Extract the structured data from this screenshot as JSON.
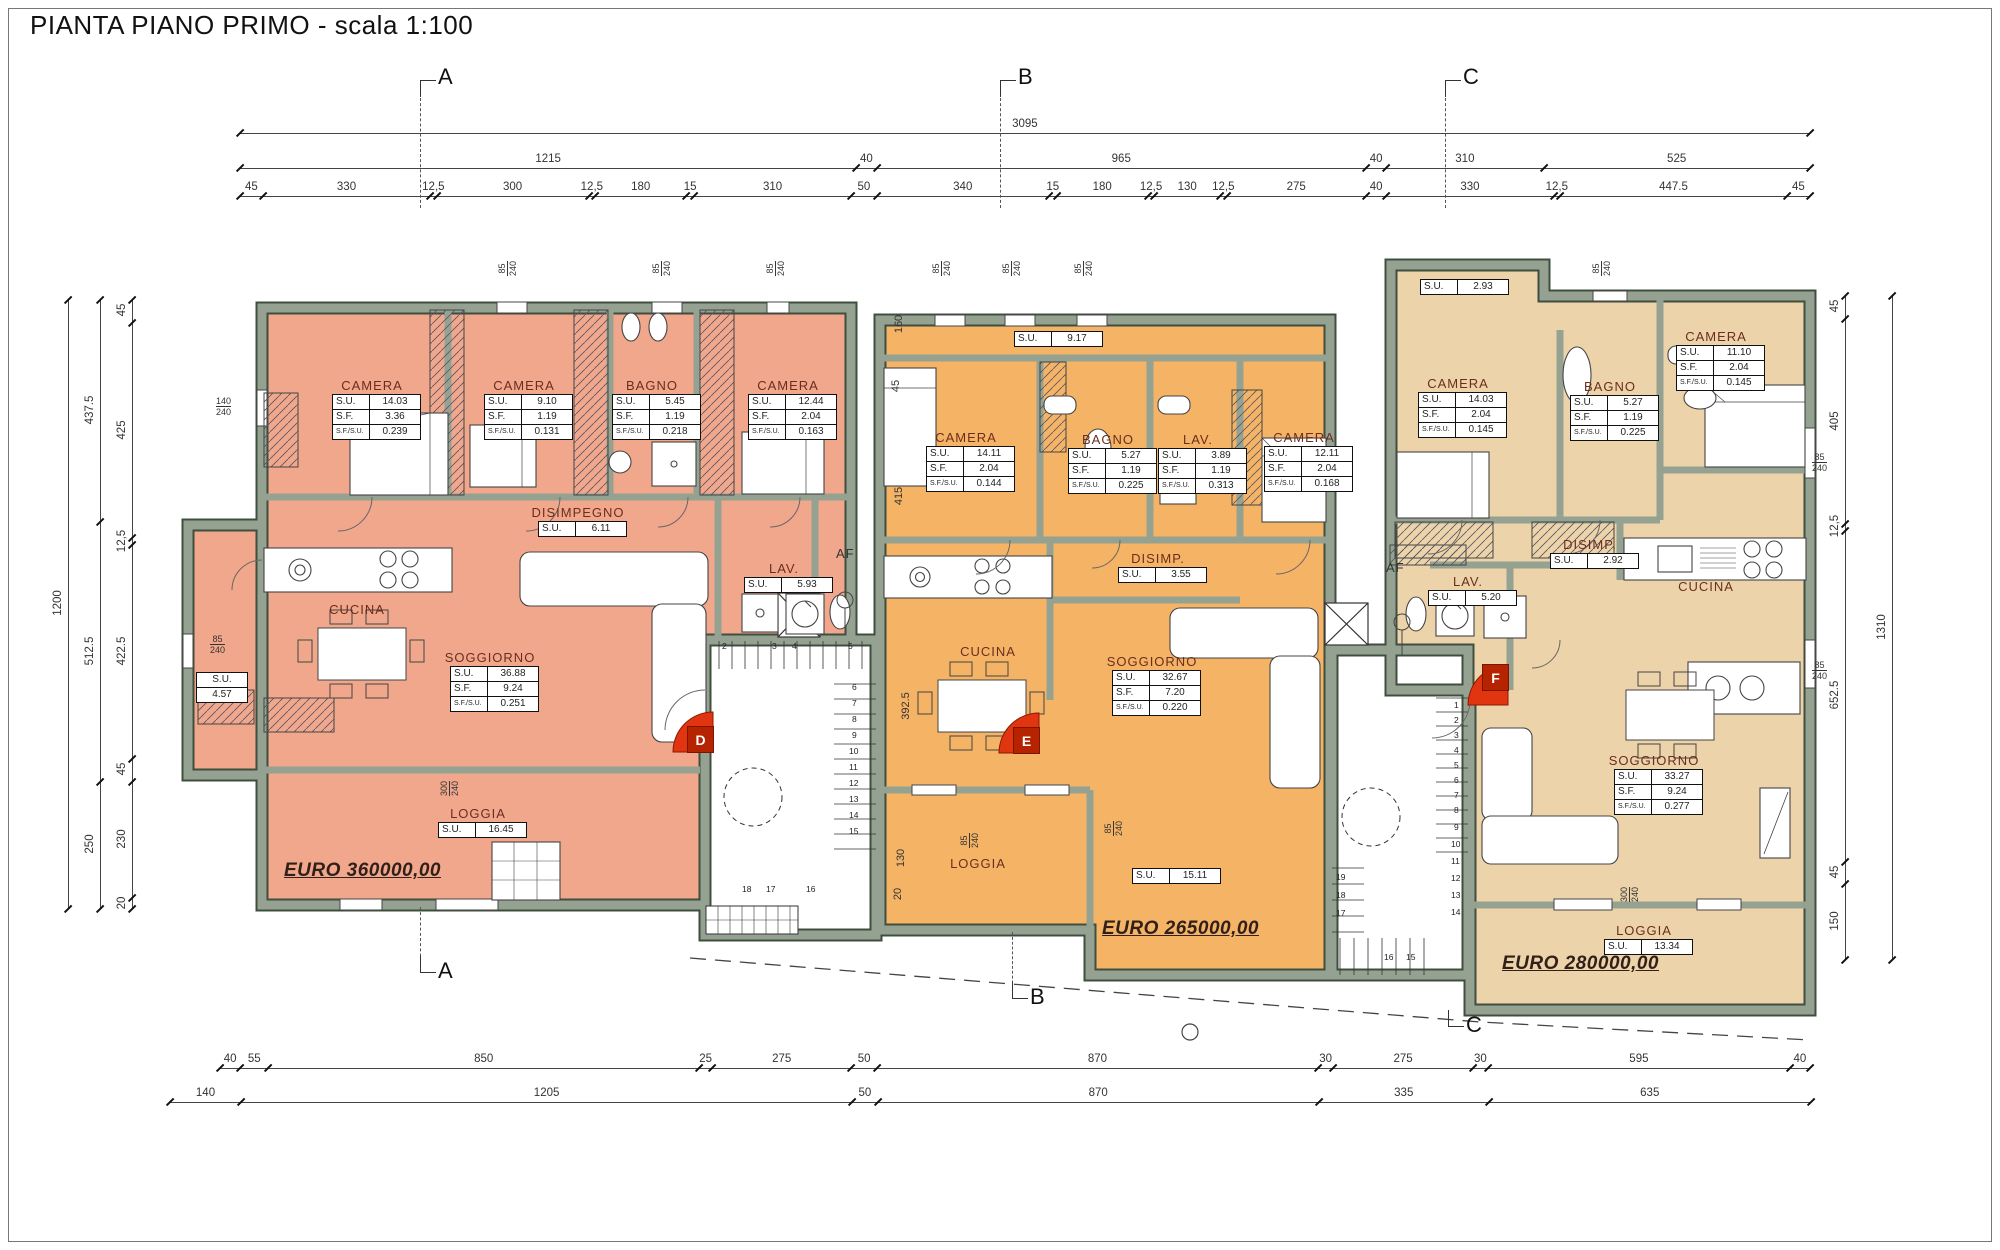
{
  "title": "PIANTA PIANO PRIMO - scala 1:100",
  "colors": {
    "apartment_d_fill": "#f1a78c",
    "apartment_e_fill": "#f5b366",
    "apartment_f_fill": "#ecd3a9",
    "wall_fill": "#95a292",
    "wall_edge": "#3f4f3f",
    "marker_red": "#e03510",
    "room_title_color": "#6b2e1e",
    "price_color": "#31201a"
  },
  "section_markers": {
    "top": [
      {
        "label": "A",
        "x": 420
      },
      {
        "label": "B",
        "x": 1000
      },
      {
        "label": "C",
        "x": 1445
      }
    ],
    "bottom": [
      {
        "label": "A",
        "x": 420,
        "y0": 907,
        "y1": 972
      },
      {
        "label": "B",
        "x": 1012,
        "y0": 932,
        "y1": 998
      },
      {
        "label": "C",
        "x": 1448,
        "y0": 1010,
        "y1": 1026
      }
    ]
  },
  "door_markers": [
    {
      "label": "D",
      "x": 687,
      "y": 726
    },
    {
      "label": "E",
      "x": 1013,
      "y": 727
    },
    {
      "label": "F",
      "x": 1482,
      "y": 664
    }
  ],
  "dimensions": {
    "scale": 0.5072,
    "top_rows": [
      {
        "y": 133,
        "x0": 240,
        "values": [
          "3095"
        ]
      },
      {
        "y": 168,
        "x0": 240,
        "values": [
          "1215",
          "40",
          "965",
          "40",
          "310",
          "525"
        ]
      },
      {
        "y": 196,
        "x0": 240,
        "values": [
          "45",
          "330",
          "12,5",
          "300",
          "12,5",
          "180",
          "15",
          "310",
          "50",
          "340",
          "15",
          "180",
          "12,5",
          "130",
          "12,5",
          "275",
          "40",
          "330",
          "12,5",
          "447.5",
          "45"
        ]
      }
    ],
    "bottom_rows": [
      {
        "y": 1068,
        "x0": 220,
        "values": [
          "40",
          "55",
          "850",
          "25",
          "275",
          "50",
          "870",
          "30",
          "275",
          "30",
          "595",
          "40"
        ]
      },
      {
        "y": 1102,
        "x0": 170,
        "values": [
          "140",
          "1205",
          "50",
          "870",
          "335",
          "635"
        ]
      }
    ],
    "left_cols": [
      {
        "x": 68,
        "y0": 300,
        "values": [
          "1200"
        ]
      },
      {
        "x": 100,
        "y0": 300,
        "values": [
          "437.5",
          "512.5",
          "250"
        ]
      },
      {
        "x": 132,
        "y0": 300,
        "values": [
          "45",
          "425",
          "12,5",
          "422.5",
          "45",
          "230",
          "20"
        ]
      }
    ],
    "right_cols": [
      {
        "x": 1845,
        "y0": 296,
        "values": [
          "45",
          "405",
          "12,5",
          "652.5",
          "45",
          "150"
        ]
      },
      {
        "x": 1892,
        "y0": 296,
        "values": [
          "1310"
        ]
      }
    ],
    "interior_rotated": [
      {
        "text": "160",
        "x": 910,
        "y": 318
      },
      {
        "text": "45",
        "x": 910,
        "y": 380
      },
      {
        "text": "415",
        "x": 910,
        "y": 490
      },
      {
        "text": "392.5",
        "x": 912,
        "y": 700
      },
      {
        "text": "130",
        "x": 912,
        "y": 852
      },
      {
        "text": "20",
        "x": 912,
        "y": 888
      }
    ]
  },
  "apartments": [
    {
      "id": "D",
      "price": "EURO 360000,00",
      "price_pos": [
        284,
        860
      ],
      "rooms": [
        {
          "name": "CAMERA",
          "su": "14.03",
          "sf": "3.36",
          "sfsu": "0.239",
          "x": 332,
          "y": 378
        },
        {
          "name": "CAMERA",
          "su": "9.10",
          "sf": "1.19",
          "sfsu": "0.131",
          "x": 484,
          "y": 378
        },
        {
          "name": "BAGNO",
          "su": "5.45",
          "sf": "1.19",
          "sfsu": "0.218",
          "x": 612,
          "y": 378
        },
        {
          "name": "CAMERA",
          "su": "12.44",
          "sf": "2.04",
          "sfsu": "0.163",
          "x": 748,
          "y": 378
        },
        {
          "name": "DISIMPEGNO",
          "su": "6.11",
          "x": 538,
          "y": 505
        },
        {
          "name": "LAV.",
          "su": "5.93",
          "x": 744,
          "y": 561
        },
        {
          "name": "CUCINA",
          "x": 317,
          "y": 602
        },
        {
          "name": "SOGGIORNO",
          "su": "36.88",
          "sf": "9.24",
          "sfsu": "0.251",
          "x": 450,
          "y": 650
        },
        {
          "name": "LOGGIA",
          "su": "16.45",
          "x": 438,
          "y": 806
        },
        {
          "su": "4.57",
          "x": 196,
          "y": 672,
          "stacked": true
        }
      ]
    },
    {
      "id": "E",
      "price": "EURO 265000,00",
      "price_pos": [
        1102,
        918
      ],
      "rooms": [
        {
          "su": "9.17",
          "x": 1014,
          "y": 331
        },
        {
          "name": "CAMERA",
          "su": "14.11",
          "sf": "2.04",
          "sfsu": "0.144",
          "x": 926,
          "y": 430
        },
        {
          "name": "BAGNO",
          "su": "5.27",
          "sf": "1.19",
          "sfsu": "0.225",
          "x": 1068,
          "y": 432
        },
        {
          "name": "LAV.",
          "su": "3.89",
          "sf": "1.19",
          "sfsu": "0.313",
          "x": 1158,
          "y": 432
        },
        {
          "name": "CAMERA",
          "su": "12.11",
          "sf": "2.04",
          "sfsu": "0.168",
          "x": 1264,
          "y": 430
        },
        {
          "name": "DISIMP.",
          "su": "3.55",
          "x": 1118,
          "y": 551
        },
        {
          "name": "CUCINA",
          "x": 948,
          "y": 644
        },
        {
          "name": "SOGGIORNO",
          "su": "32.67",
          "sf": "7.20",
          "sfsu": "0.220",
          "x": 1112,
          "y": 654
        },
        {
          "name": "LOGGIA",
          "x": 938,
          "y": 856
        },
        {
          "su": "15.11",
          "x": 1132,
          "y": 868
        }
      ]
    },
    {
      "id": "F",
      "price": "EURO 280000,00",
      "price_pos": [
        1502,
        953
      ],
      "rooms": [
        {
          "su": "2.93",
          "x": 1420,
          "y": 279
        },
        {
          "name": "CAMERA",
          "su": "14.03",
          "sf": "2.04",
          "sfsu": "0.145",
          "x": 1418,
          "y": 376
        },
        {
          "name": "BAGNO",
          "su": "5.27",
          "sf": "1.19",
          "sfsu": "0.225",
          "x": 1570,
          "y": 379
        },
        {
          "name": "CAMERA",
          "su": "11.10",
          "sf": "2.04",
          "sfsu": "0.145",
          "x": 1676,
          "y": 329
        },
        {
          "name": "DISIMP.",
          "su": "2.92",
          "x": 1550,
          "y": 537
        },
        {
          "name": "LAV.",
          "su": "5.20",
          "x": 1428,
          "y": 574
        },
        {
          "name": "CUCINA",
          "x": 1666,
          "y": 579
        },
        {
          "name": "SOGGIORNO",
          "su": "33.27",
          "sf": "9.24",
          "sfsu": "0.277",
          "x": 1614,
          "y": 753
        },
        {
          "name": "LOGGIA",
          "su": "13.34",
          "x": 1604,
          "y": 923
        }
      ]
    }
  ],
  "table_labels": {
    "su": "S.U.",
    "sf": "S.F.",
    "sfsu": "S.F./S.U."
  },
  "annotations": {
    "af_labels": [
      {
        "text": "AF",
        "x": 836,
        "y": 546
      },
      {
        "text": "AF",
        "x": 1386,
        "y": 560
      }
    ],
    "window_labels": [
      {
        "lines": [
          "85",
          "240"
        ],
        "x": 500,
        "y": 258,
        "rot": true
      },
      {
        "lines": [
          "85",
          "240"
        ],
        "x": 654,
        "y": 258,
        "rot": true
      },
      {
        "lines": [
          "85",
          "240"
        ],
        "x": 768,
        "y": 258,
        "rot": true
      },
      {
        "lines": [
          "140",
          "240"
        ],
        "x": 216,
        "y": 396,
        "rot": false
      },
      {
        "lines": [
          "85",
          "240"
        ],
        "x": 210,
        "y": 634,
        "rot": false
      },
      {
        "lines": [
          "300",
          "240"
        ],
        "x": 442,
        "y": 778,
        "rot": true
      },
      {
        "lines": [
          "85",
          "240"
        ],
        "x": 934,
        "y": 258,
        "rot": true
      },
      {
        "lines": [
          "85",
          "240"
        ],
        "x": 1004,
        "y": 258,
        "rot": true
      },
      {
        "lines": [
          "85",
          "240"
        ],
        "x": 1076,
        "y": 258,
        "rot": true
      },
      {
        "lines": [
          "85",
          "240"
        ],
        "x": 962,
        "y": 830,
        "rot": true
      },
      {
        "lines": [
          "85",
          "240"
        ],
        "x": 1106,
        "y": 818,
        "rot": true
      },
      {
        "lines": [
          "85",
          "240"
        ],
        "x": 1594,
        "y": 258,
        "rot": true
      },
      {
        "lines": [
          "85",
          "240"
        ],
        "x": 1812,
        "y": 452,
        "rot": false
      },
      {
        "lines": [
          "85",
          "240"
        ],
        "x": 1812,
        "y": 660,
        "rot": false
      },
      {
        "lines": [
          "300",
          "240"
        ],
        "x": 1622,
        "y": 884,
        "rot": true
      }
    ],
    "stair_numbers": {
      "core1": [
        [
          "2",
          722,
          641
        ],
        [
          "3",
          772,
          641
        ],
        [
          "4",
          792,
          641
        ],
        [
          "5",
          848,
          641
        ],
        [
          "6",
          852,
          682
        ],
        [
          "7",
          852,
          698
        ],
        [
          "8",
          852,
          714
        ],
        [
          "9",
          852,
          730
        ],
        [
          "10",
          849,
          746
        ],
        [
          "11",
          849,
          762
        ],
        [
          "12",
          849,
          778
        ],
        [
          "13",
          849,
          794
        ],
        [
          "14",
          849,
          810
        ],
        [
          "15",
          849,
          826
        ],
        [
          "18",
          742,
          884
        ],
        [
          "17",
          766,
          884
        ],
        [
          "16",
          806,
          884
        ]
      ],
      "core2": [
        [
          "1",
          1454,
          700
        ],
        [
          "2",
          1454,
          715
        ],
        [
          "3",
          1454,
          730
        ],
        [
          "4",
          1454,
          745
        ],
        [
          "5",
          1454,
          760
        ],
        [
          "6",
          1454,
          775
        ],
        [
          "7",
          1454,
          790
        ],
        [
          "8",
          1454,
          805
        ],
        [
          "9",
          1454,
          822
        ],
        [
          "10",
          1451,
          839
        ],
        [
          "11",
          1451,
          856
        ],
        [
          "12",
          1451,
          873
        ],
        [
          "13",
          1451,
          890
        ],
        [
          "14",
          1451,
          907
        ],
        [
          "19",
          1336,
          872
        ],
        [
          "18",
          1336,
          890
        ],
        [
          "17",
          1336,
          908
        ],
        [
          "16",
          1384,
          952
        ],
        [
          "15",
          1406,
          952
        ]
      ]
    }
  }
}
